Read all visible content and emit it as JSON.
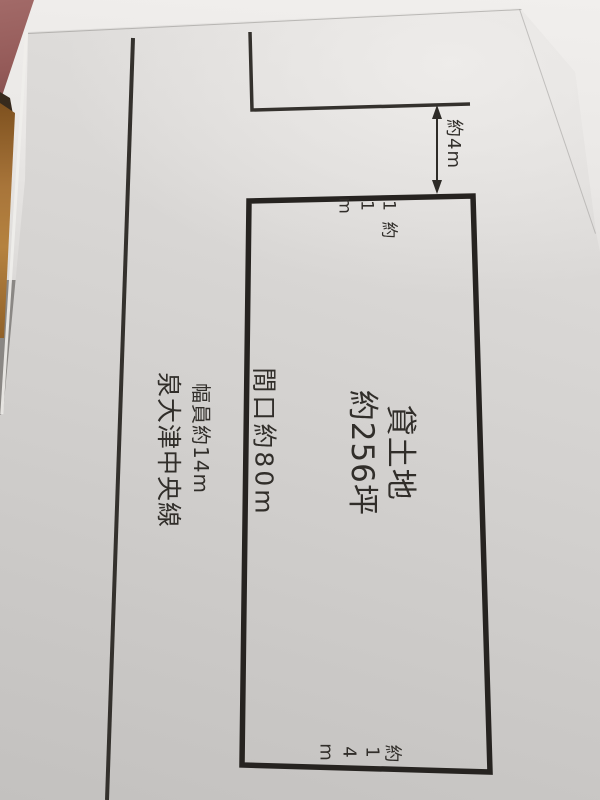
{
  "diagram": {
    "title_line1": "貸土地",
    "title_line2": "約256坪",
    "frontage_label": "間口約80m",
    "gap_dimension": "約4m",
    "top_dimension": "約11m",
    "bottom_dimension": "約14m",
    "road_width_label": "幅員約14m",
    "road_name_label": "泉大津中央線"
  },
  "colors": {
    "ink": "#2b2824",
    "paper_main": "#d5d3d1",
    "paper_under": "#eeecea",
    "table_maroon": "#945a58",
    "table_wood": "#a8753a"
  }
}
